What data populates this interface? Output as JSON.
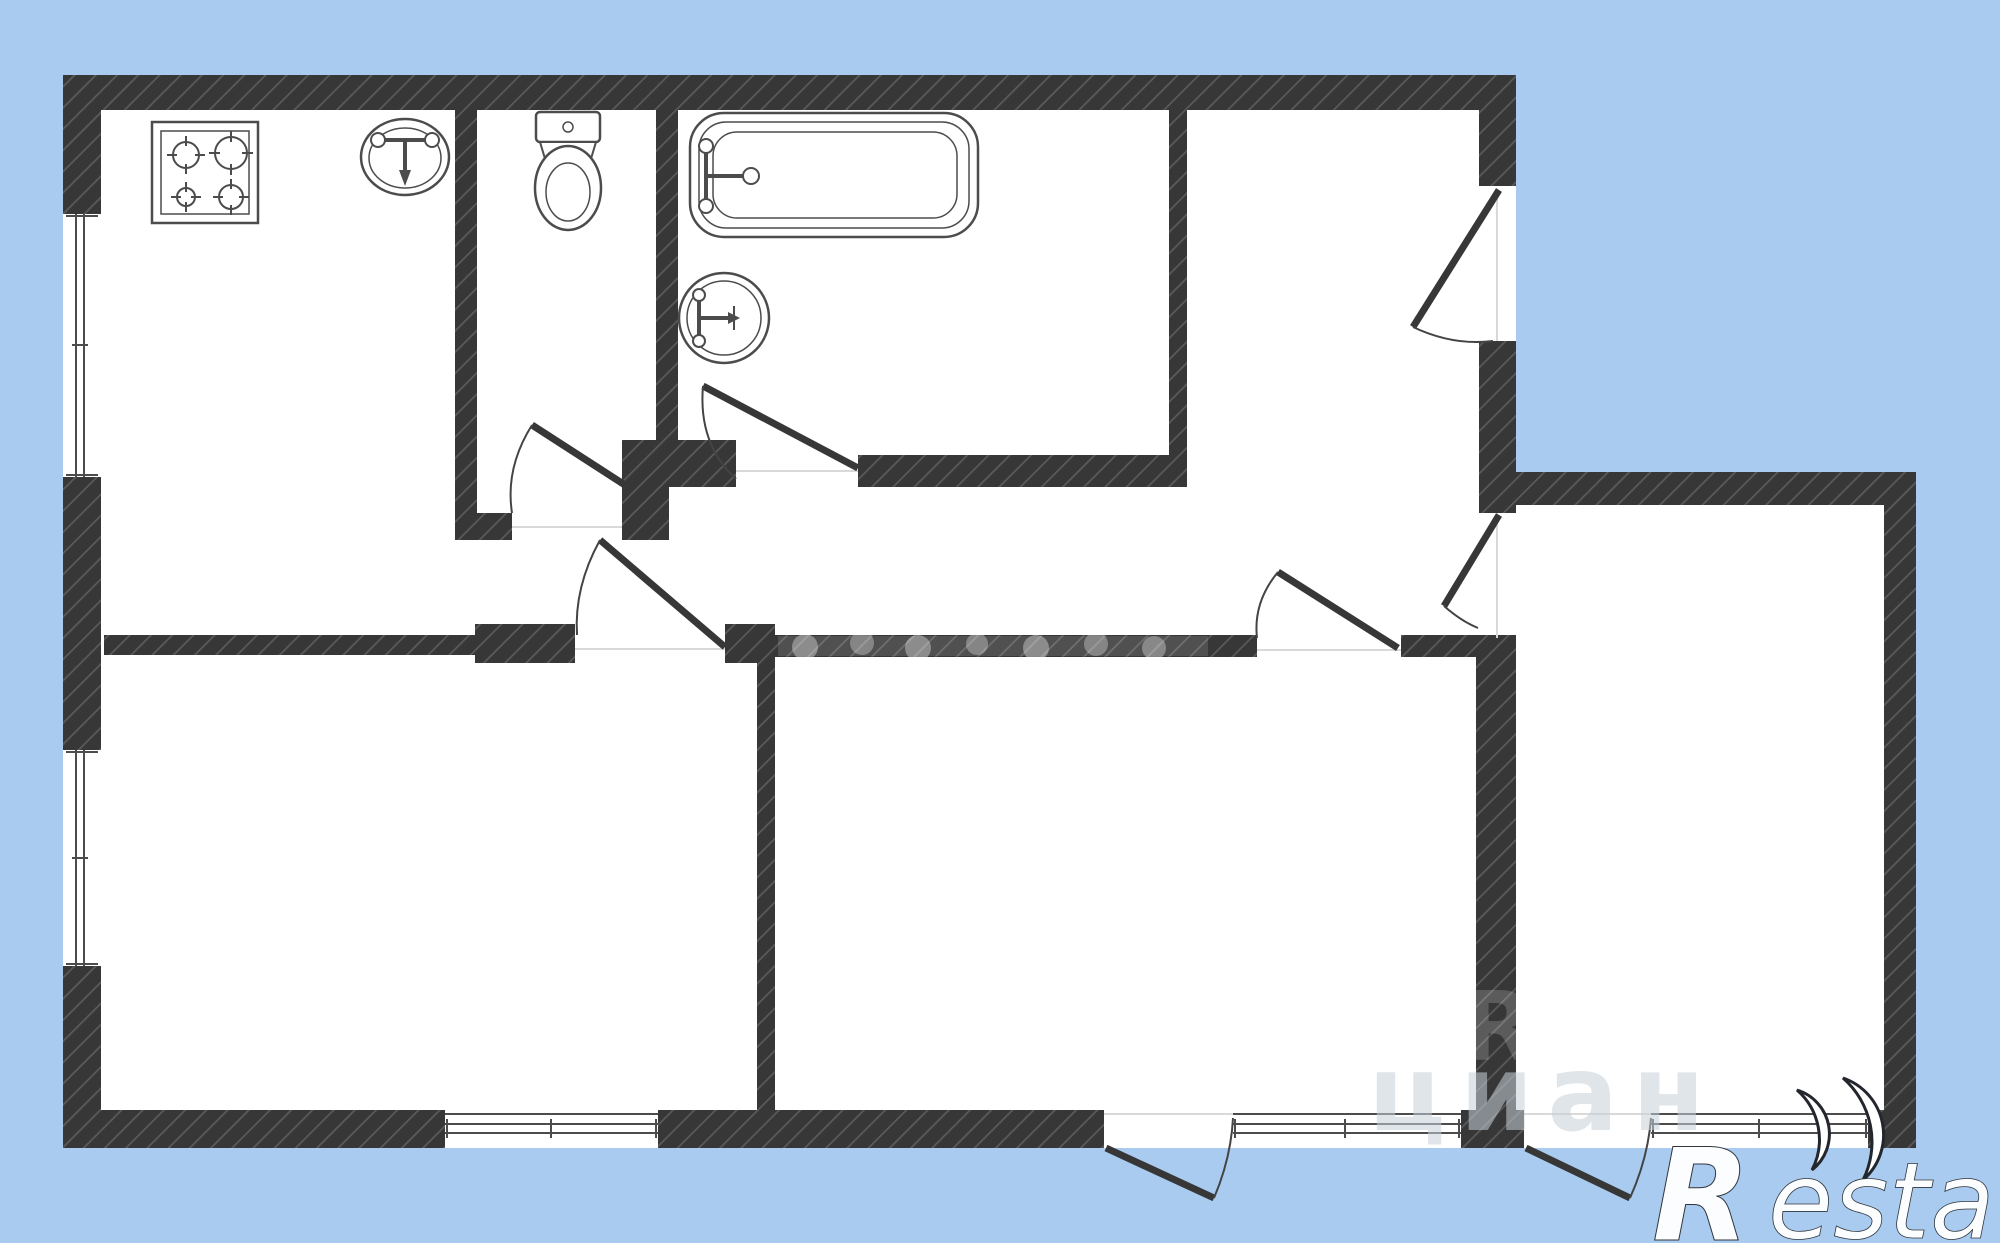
{
  "canvas": {
    "background_color": "#a9cbf0",
    "wall_color": "#373737",
    "wall_hatch_color": "#5a5a5a",
    "fixture_line_color": "#4c4c4c",
    "floor_color": "#ffffff"
  },
  "watermark": {
    "portal_text": "циан",
    "wall_letter": "R"
  },
  "logo": {
    "letter": "R",
    "rest": "estate"
  },
  "icons": [
    {
      "name": "stove-icon"
    },
    {
      "name": "kitchen-sink-icon"
    },
    {
      "name": "toilet-icon"
    },
    {
      "name": "bathtub-icon"
    },
    {
      "name": "washbasin-icon"
    },
    {
      "name": "window-icon"
    },
    {
      "name": "door-swing-icon"
    },
    {
      "name": "restate-logo"
    }
  ]
}
